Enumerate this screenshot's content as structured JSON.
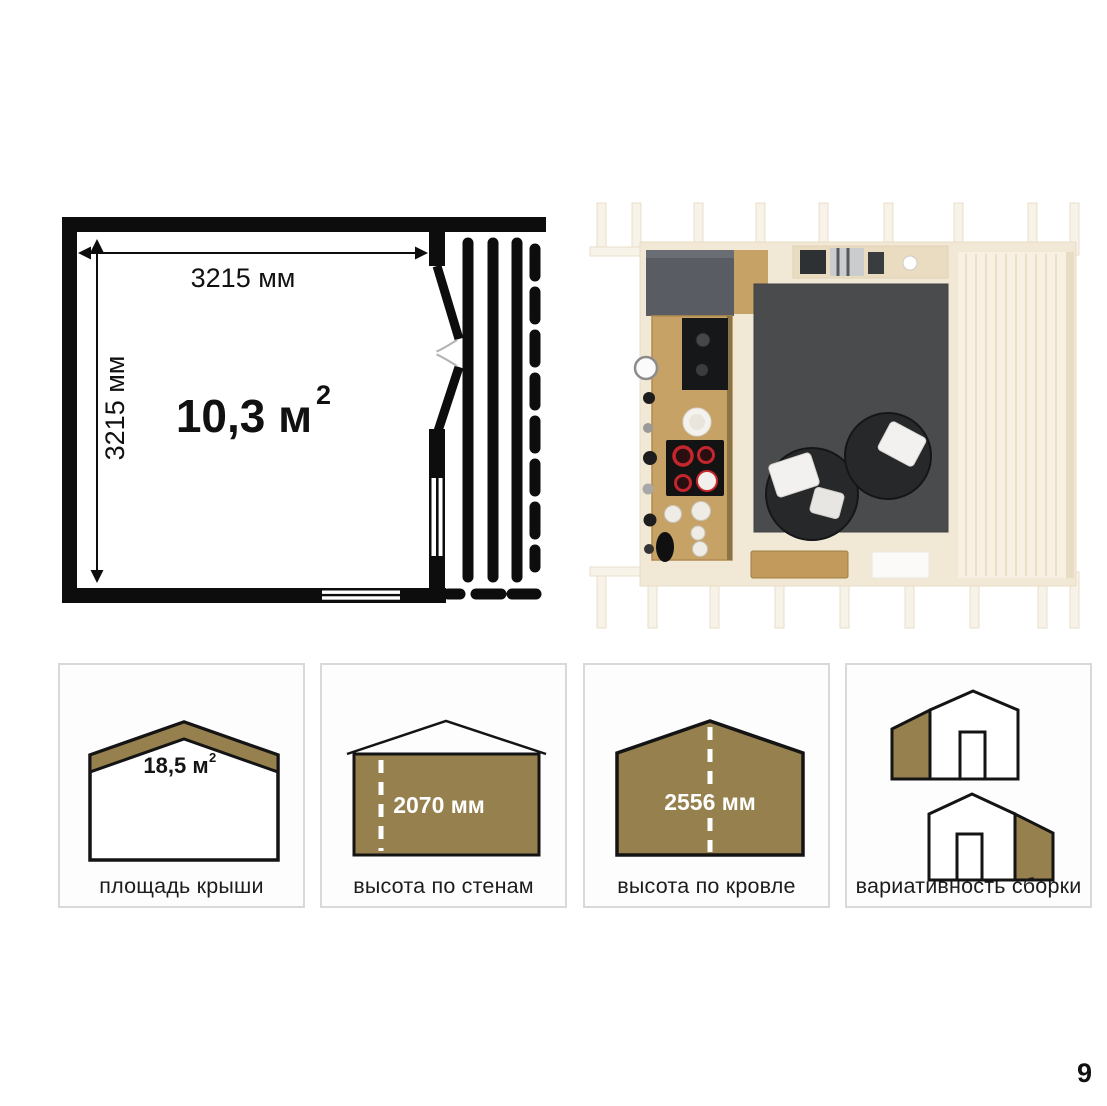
{
  "page": {
    "number": "9"
  },
  "floor_plan": {
    "width_label": "3215 мм",
    "height_label": "3215 мм",
    "area_value": "10,3 м",
    "area_sup": "2"
  },
  "render": {
    "type": "top-down interior render of cabin with kitchen, two lounge chairs, rug and side terrace"
  },
  "cards": [
    {
      "icon": "roof-area-icon",
      "value": "18,5 м",
      "sup": "2",
      "label": "площадь крыши"
    },
    {
      "icon": "wall-height-icon",
      "value": "2070 мм",
      "label": "высота по стенам"
    },
    {
      "icon": "roof-height-icon",
      "value": "2556 мм",
      "label": "высота по кровле"
    },
    {
      "icon": "assembly-variants-icon",
      "label": "вариативность сборки"
    }
  ],
  "colors": {
    "accent_brown": "#95804E",
    "line_black": "#0d0d0d",
    "card_border": "#d9d9d9",
    "card_background": "#fdfdfd",
    "render_wood": "#f2e8d6",
    "render_rug": "#4a4b4d"
  }
}
